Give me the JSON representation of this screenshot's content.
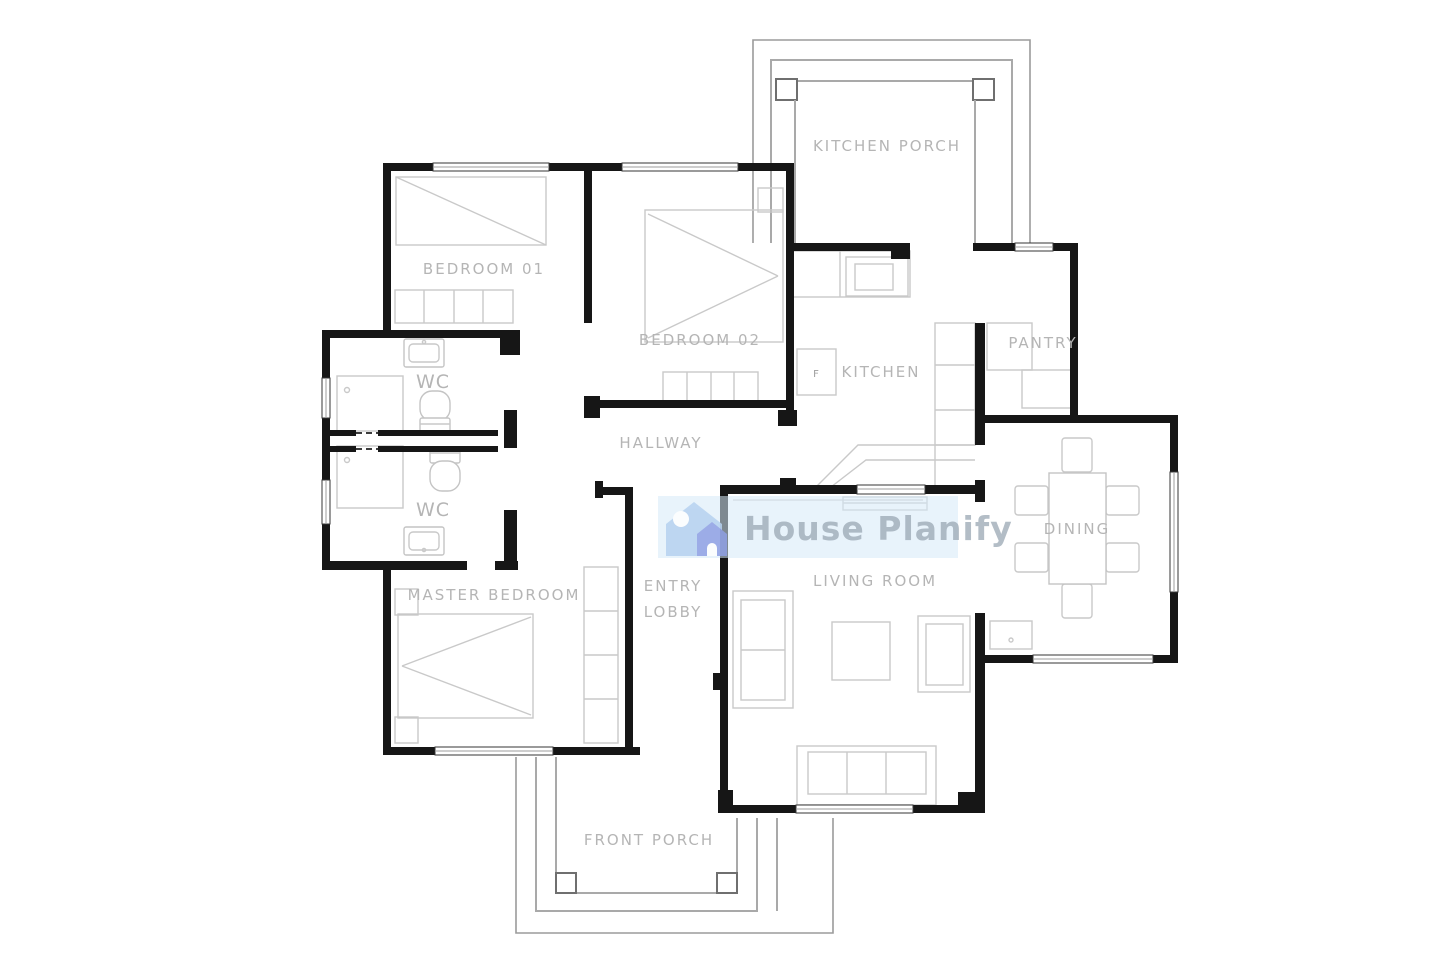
{
  "watermark": {
    "brand": "House Planify"
  },
  "rooms": {
    "kitchen_porch": "KITCHEN PORCH",
    "bedroom_01": "BEDROOM 01",
    "bedroom_02": "BEDROOM 02",
    "kitchen": "KITCHEN",
    "pantry": "PANTRY",
    "wc_upper": "WC",
    "wc_lower": "WC",
    "hallway": "HALLWAY",
    "dining": "DINING",
    "master_bedroom": "MASTER BEDROOM",
    "entry_line1": "ENTRY",
    "entry_line2": "LOBBY",
    "living_room": "LIVING ROOM",
    "front_porch": "FRONT PORCH"
  },
  "fixtures": {
    "fridge": "F"
  },
  "colors": {
    "wall": "#161616",
    "furniture": "#c9c9c9",
    "label": "#b5b5b5",
    "porch_line": "#a9a9a9",
    "watermark_bg": "#ddeaf7",
    "watermark_text": "#9aa7b4",
    "icon_light_blue": "#b6d1f0",
    "icon_periwinkle": "#8fa0e4"
  }
}
